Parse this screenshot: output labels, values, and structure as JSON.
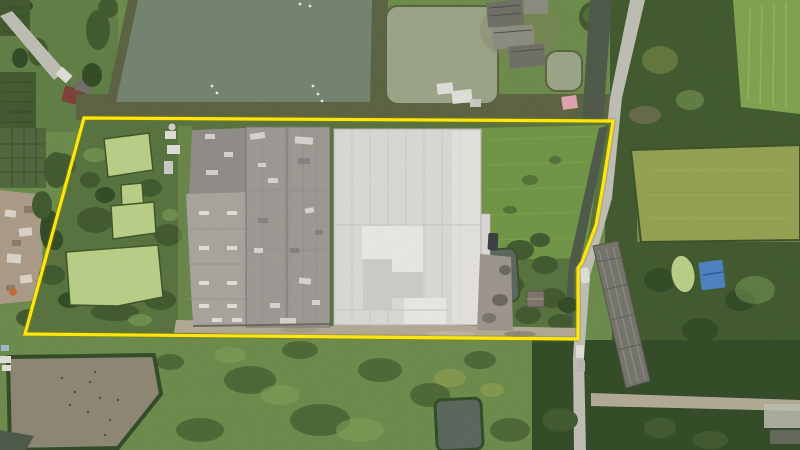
{
  "scene": {
    "type": "aerial-drone-photograph",
    "description": "Top-down aerial photo of an industrial plot outlined with a yellow property boundary. Inside: two large warehouse roofs (one weathered grey, one light white-grey), four duckweed-covered ponds on the west side, a bright green field and a dark canal strip on the east. Surroundings: large grey-green fish ponds to the north, farm buildings top-right, rice paddies on the east, a concrete road with a canal running north-south, a long dark-roofed building east of the road, green fields and a drained muddy pond to the south.",
    "annotation": {
      "label": "property-boundary",
      "color": "#ffe60a",
      "points": "84,118 613,121 603,185 596,225 582,262 578,268 578,339 25,334"
    },
    "palette": {
      "boundary_yellow": "#ffe60a",
      "boundary_glow": "#8a7d00",
      "grass_base": "#6b8a4a",
      "grass_tl": "#5f7d44",
      "grass_interior": "#57723e",
      "grass_bright": "#6f9444",
      "grass_light": "#82a058",
      "grass_plots": "#50663c",
      "trees_dark": "#41592e",
      "trees_darker": "#324b26",
      "pond_gray": "#73816f",
      "pond_sage": "#99a385",
      "pond_duckweed": "#b7cd85",
      "pond_mud": "#8b8672",
      "pond_dark": "#5a665c",
      "canal_dark": "#4d5848",
      "bank_dark": "#5a6241",
      "road_concrete": "#bdbcb2",
      "road_dirt": "#b1a894",
      "roof_left_main": "#9b9792",
      "roof_left_wing": "#8e8b86",
      "roof_left_lower": "#a6a39d",
      "roof_right": "#d7d6d2",
      "roof_right_light": "#e6e5e1",
      "roof_right_mid": "#cbc9c5",
      "roof_farm": "#6e6e66",
      "roof_farm_light": "#8a8a80",
      "roof_long": "#73736b",
      "rubble": "#a89a86",
      "rubble_light": "#d8d2c6",
      "rubble_brown": "#8a7a62",
      "paddy_bright": "#7da24f",
      "paddy_olive": "#93a050",
      "tarp_blue": "#4d80bf",
      "tarp_pink": "#dca3af",
      "roof_red": "#7c4038",
      "white_detail": "#dddcd6",
      "car_dark": "#3a3d42",
      "gravel": "#9a948a",
      "orange": "#c06a38"
    }
  }
}
